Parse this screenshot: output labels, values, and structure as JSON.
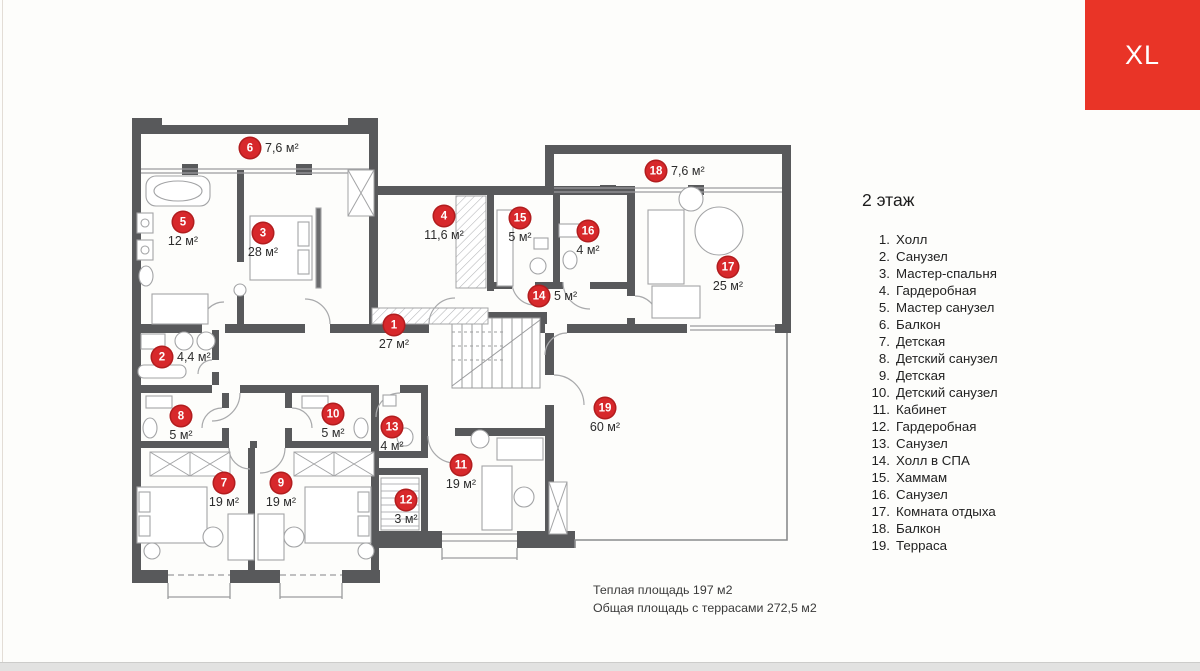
{
  "badge": {
    "label": "XL",
    "color": "#e93427"
  },
  "legend": {
    "title": "2 этаж",
    "items": [
      {
        "num": "1.",
        "label": "Холл"
      },
      {
        "num": "2.",
        "label": "Санузел"
      },
      {
        "num": "3.",
        "label": "Мастер-спальня"
      },
      {
        "num": "4.",
        "label": "Гардеробная"
      },
      {
        "num": "5.",
        "label": "Мастер санузел"
      },
      {
        "num": "6.",
        "label": "Балкон"
      },
      {
        "num": "7.",
        "label": "Детская"
      },
      {
        "num": "8.",
        "label": "Детский санузел"
      },
      {
        "num": "9.",
        "label": "Детская"
      },
      {
        "num": "10.",
        "label": "Детский санузел"
      },
      {
        "num": "11.",
        "label": "Кабинет"
      },
      {
        "num": "12.",
        "label": "Гардеробная"
      },
      {
        "num": "13.",
        "label": "Санузел"
      },
      {
        "num": "14.",
        "label": "Холл в СПА"
      },
      {
        "num": "15.",
        "label": "Хаммам"
      },
      {
        "num": "16.",
        "label": "Санузел"
      },
      {
        "num": "17.",
        "label": "Комната отдыха"
      },
      {
        "num": "18.",
        "label": "Балкон"
      },
      {
        "num": "19.",
        "label": "Терраса"
      }
    ]
  },
  "totals": {
    "line1": "Теплая площадь 197 м2",
    "line2": "Общая площадь с террасами 272,5 м2"
  },
  "plan": {
    "marker_color": "#d7282b",
    "wall_color": "#58595b",
    "markers": [
      {
        "n": "1",
        "x": 394,
        "y": 325,
        "area": "27 м²",
        "placement": "below"
      },
      {
        "n": "2",
        "x": 162,
        "y": 357,
        "area": "4,4 м²",
        "placement": "right"
      },
      {
        "n": "3",
        "x": 263,
        "y": 233,
        "area": "28 м²",
        "placement": "below"
      },
      {
        "n": "4",
        "x": 444,
        "y": 216,
        "area": "11,6 м²",
        "placement": "below"
      },
      {
        "n": "5",
        "x": 183,
        "y": 222,
        "area": "12 м²",
        "placement": "below"
      },
      {
        "n": "6",
        "x": 250,
        "y": 148,
        "area": "7,6 м²",
        "placement": "right"
      },
      {
        "n": "7",
        "x": 224,
        "y": 483,
        "area": "19 м²",
        "placement": "below"
      },
      {
        "n": "8",
        "x": 181,
        "y": 416,
        "area": "5 м²",
        "placement": "below"
      },
      {
        "n": "9",
        "x": 281,
        "y": 483,
        "area": "19 м²",
        "placement": "below"
      },
      {
        "n": "10",
        "x": 333,
        "y": 414,
        "area": "5 м²",
        "placement": "below"
      },
      {
        "n": "11",
        "x": 461,
        "y": 465,
        "area": "19 м²",
        "placement": "below"
      },
      {
        "n": "12",
        "x": 406,
        "y": 500,
        "area": "3 м²",
        "placement": "below"
      },
      {
        "n": "13",
        "x": 392,
        "y": 427,
        "area": "4 м²",
        "placement": "below"
      },
      {
        "n": "14",
        "x": 539,
        "y": 296,
        "area": "5 м²",
        "placement": "right"
      },
      {
        "n": "15",
        "x": 520,
        "y": 218,
        "area": "5 м²",
        "placement": "below"
      },
      {
        "n": "16",
        "x": 588,
        "y": 231,
        "area": "4 м²",
        "placement": "below"
      },
      {
        "n": "17",
        "x": 728,
        "y": 267,
        "area": "25 м²",
        "placement": "below"
      },
      {
        "n": "18",
        "x": 656,
        "y": 171,
        "area": "7,6 м²",
        "placement": "right"
      },
      {
        "n": "19",
        "x": 605,
        "y": 408,
        "area": "60 м²",
        "placement": "below"
      }
    ]
  }
}
